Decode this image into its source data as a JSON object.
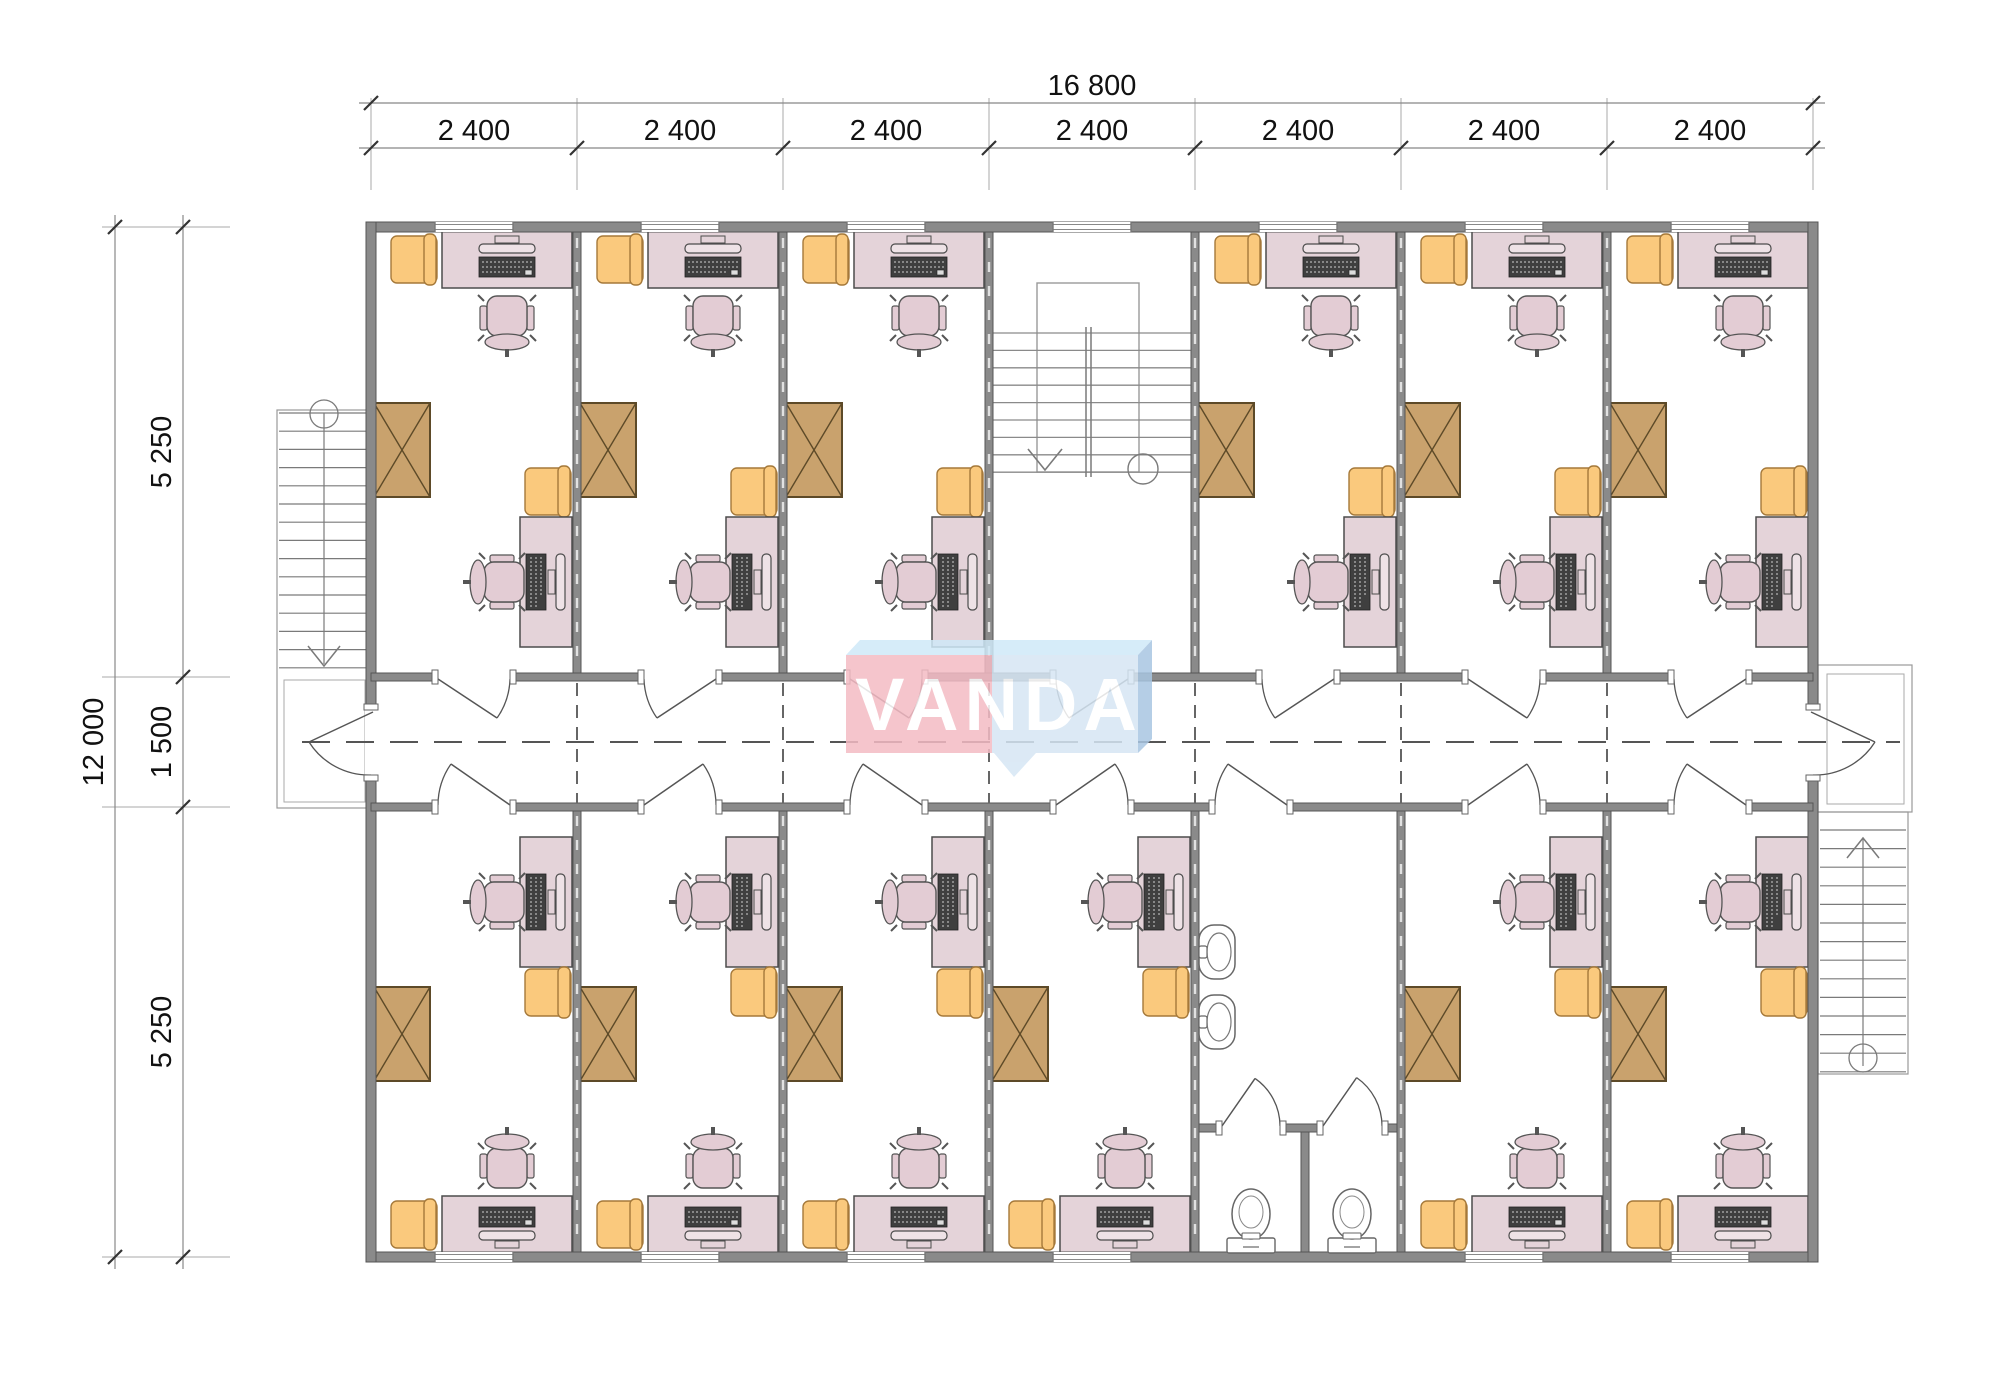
{
  "title": "Floor plan with offices, corridor, stairs and sanitary block",
  "dimensions": {
    "top_total": "16 800",
    "top_segments": [
      "2 400",
      "2 400",
      "2 400",
      "2 400",
      "2 400",
      "2 400",
      "2 400"
    ],
    "left_total": "12 000",
    "left_segments": [
      "5 250",
      "1 500",
      "5 250"
    ]
  },
  "logo": {
    "text": "VANDA",
    "pink": "#f4bbc4",
    "blue": "#d6e6f4",
    "top_face": "#cfe9f8",
    "side_face": "#a9c6e2",
    "text_color": "#ffffff"
  },
  "plan": {
    "canvas": {
      "w": 2000,
      "h": 1380
    },
    "grid_x": [
      371,
      577,
      783,
      989,
      1195,
      1401,
      1607,
      1813
    ],
    "grid_y": [
      227,
      677,
      807,
      1257
    ],
    "top_rooms": [
      "office",
      "office",
      "office",
      "stairwell",
      "office",
      "office",
      "office"
    ],
    "bottom_rooms": [
      "office",
      "office",
      "office",
      "office",
      "bathroom",
      "office",
      "office"
    ],
    "door_hinges_top": [
      "L",
      "R",
      "L",
      "R",
      "R",
      "L",
      "R"
    ],
    "door_hinges_bottom": [
      "R",
      "L",
      "R",
      "L",
      "R",
      "L",
      "R"
    ],
    "bathroom": {
      "entrance_opening": [
        1215,
        1287
      ],
      "stall_openings": [
        [
          1222,
          1280
        ],
        [
          1323,
          1382
        ]
      ],
      "divider_x": 1305,
      "partition_y": 1128,
      "sink_y": [
        925,
        995
      ],
      "toilet_cx": [
        1251,
        1352
      ]
    },
    "colors": {
      "wall_fill": "#8a8a8a",
      "wall_stroke": "#555555",
      "desk_fill": "#e4d3d9",
      "desk_stroke": "#4c4c4c",
      "chair_fill": "#e3ccd4",
      "armchair_fill": "#fac97d",
      "armchair_stroke": "#a5793a",
      "wardrobe_fill": "#c9a26d",
      "wardrobe_stroke": "#5d4a28",
      "stair_line": "#7a7a7a",
      "outline": "#999999",
      "keyboard": "#3f3f3f",
      "dash": "#555555",
      "dim_line": "#888888",
      "dim_text": "#111111",
      "white": "#ffffff"
    }
  }
}
